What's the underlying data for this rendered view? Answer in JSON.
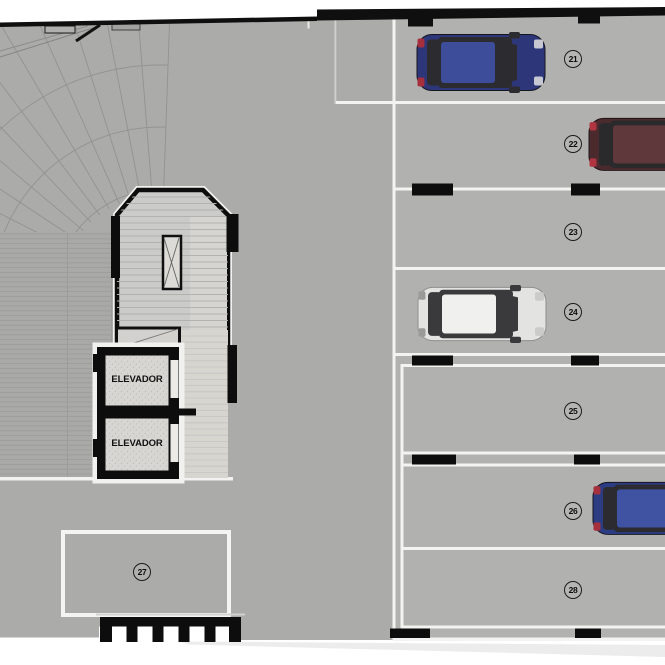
{
  "plan": {
    "description": "Parking garage floor plan with curved ramp, stair core, two elevators and numbered stalls"
  },
  "elevators": [
    {
      "label": "ELEVADOR"
    },
    {
      "label": "ELEVADOR"
    }
  ],
  "parking_spaces": [
    {
      "number": "21",
      "status": "occupied",
      "car": "blue"
    },
    {
      "number": "22",
      "status": "occupied",
      "car": "dark-red"
    },
    {
      "number": "23",
      "status": "empty",
      "car": null
    },
    {
      "number": "24",
      "status": "occupied",
      "car": "white"
    },
    {
      "number": "25",
      "status": "empty",
      "car": null
    },
    {
      "number": "26",
      "status": "occupied",
      "car": "blue"
    },
    {
      "number": "27",
      "status": "empty",
      "car": null
    },
    {
      "number": "28",
      "status": "empty",
      "car": null
    }
  ],
  "cars": {
    "car_21": {
      "body": "#2c3679",
      "roof": "#3e4d9a",
      "glass": "#2c2c30",
      "tail": "#a52f3c",
      "head": "#d8d8da"
    },
    "car_22": {
      "body": "#4a2a2d",
      "roof": "#5e383b",
      "glass": "#2a2a2c",
      "tail": "#b03540",
      "head": "#d8d8da"
    },
    "car_24": {
      "body": "#e3e3e1",
      "roof": "#f0f0ee",
      "glass": "#3a3a3c",
      "tail": "#9a9a98",
      "head": "#c8c8c6"
    },
    "car_26": {
      "body": "#2c3c83",
      "roof": "#4052a2",
      "glass": "#2c2c30",
      "tail": "#a52f3c",
      "head": "#d8d8da"
    }
  },
  "colors": {
    "floor": "#ababa9",
    "parking_strip": "#b1b1af",
    "line_white": "#f3f3f1",
    "wall_black": "#0d0d0d",
    "ramp_line": "#92928f",
    "stripe_line": "#9a9a97",
    "core_fill": "#cbcbc9",
    "corridor_fill": "#d7d5d0",
    "elevator_fill": "#d8d6d2"
  }
}
